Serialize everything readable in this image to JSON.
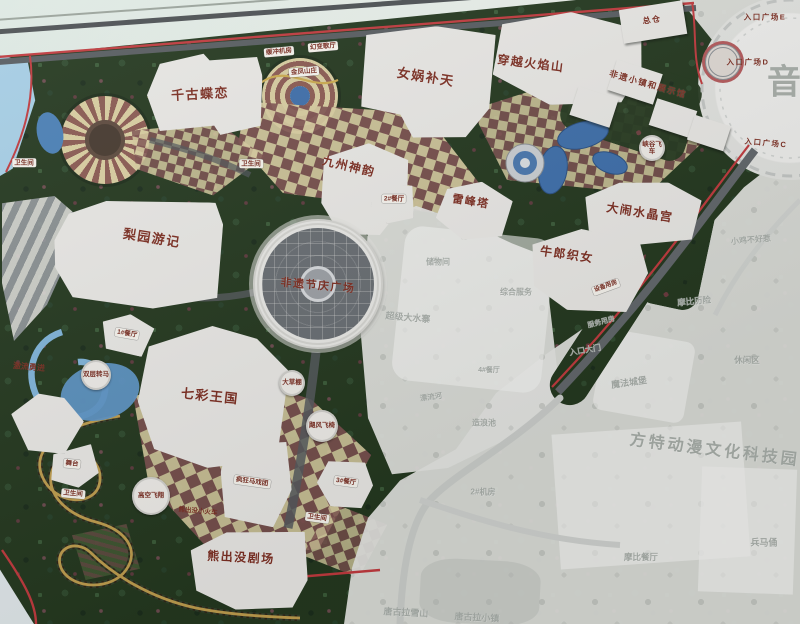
{
  "colors": {
    "label_red": "#7a2f24",
    "boundary_red": "#bf3a3e",
    "ghost_gray": "#a7ada8",
    "building_white": "#e7e6e3",
    "foliage_green": "#24381f",
    "checker_maroon": "#7d5150",
    "checker_cream": "#d6cb9f",
    "water_blue": "#3e6ea9",
    "coaster_gold": "#bd9c4e",
    "plaza_gray": "#686d72"
  },
  "labels": {
    "major": [
      {
        "name": "label-qiangu-dielian",
        "text": "千古蝶恋",
        "x": 200,
        "y": 93,
        "rot": -3,
        "fs": 13
      },
      {
        "name": "label-nuwa-butian",
        "text": "女娲补天",
        "x": 426,
        "y": 76,
        "rot": 9,
        "fs": 13
      },
      {
        "name": "label-chuanyue-huoyanshan",
        "text": "穿越火焰山",
        "x": 531,
        "y": 63,
        "rot": 7,
        "fs": 12
      },
      {
        "name": "label-jiuzhou-shenyun",
        "text": "九州神韵",
        "x": 349,
        "y": 166,
        "rot": 13,
        "fs": 12
      },
      {
        "name": "label-leifengta",
        "text": "雷峰塔",
        "x": 471,
        "y": 201,
        "rot": 9,
        "fs": 11
      },
      {
        "name": "label-danao-shuijinggong",
        "text": "大闹水晶宫",
        "x": 640,
        "y": 212,
        "rot": 9,
        "fs": 12
      },
      {
        "name": "label-niulang-zhinv",
        "text": "牛郎织女",
        "x": 567,
        "y": 254,
        "rot": 8,
        "fs": 12
      },
      {
        "name": "label-liyuan-youji",
        "text": "梨园游记",
        "x": 152,
        "y": 237,
        "rot": 9,
        "fs": 13
      },
      {
        "name": "label-feiyi-jieqing-plaza",
        "text": "非遗节庆广场",
        "x": 318,
        "y": 285,
        "rot": 5,
        "fs": 11
      },
      {
        "name": "label-qicai-wangguo",
        "text": "七彩王国",
        "x": 210,
        "y": 395,
        "rot": 6,
        "fs": 13
      },
      {
        "name": "label-xiongchumo-juchang",
        "text": "熊出没剧场",
        "x": 241,
        "y": 557,
        "rot": 3,
        "fs": 12
      },
      {
        "name": "label-zongcang",
        "text": "总仓",
        "x": 652,
        "y": 20,
        "rot": -8,
        "fs": 8
      },
      {
        "name": "label-feiyi-xiaozhen",
        "text": "非遗小镇和展示馆",
        "x": 648,
        "y": 84,
        "rot": 16,
        "fs": 8.5
      },
      {
        "name": "label-entrance-plaza-e",
        "text": "入口广场E",
        "x": 765,
        "y": 17,
        "rot": 0,
        "fs": 7.5
      },
      {
        "name": "label-entrance-plaza-d",
        "text": "入口广场D",
        "x": 748,
        "y": 62,
        "rot": 0,
        "fs": 7.5
      },
      {
        "name": "label-entrance-plaza-c",
        "text": "入口广场C",
        "x": 766,
        "y": 143,
        "rot": 5,
        "fs": 7.5
      }
    ],
    "pills": [
      {
        "name": "label-toilet-1",
        "text": "卫生间",
        "x": 24,
        "y": 163,
        "rot": 0
      },
      {
        "name": "label-toilet-2",
        "text": "卫生间",
        "x": 251,
        "y": 164,
        "rot": 0
      },
      {
        "name": "label-huanchong-jifang",
        "text": "缓冲机房",
        "x": 279,
        "y": 52,
        "rot": -5
      },
      {
        "name": "label-huanbian-geting",
        "text": "幻变歌厅",
        "x": 323,
        "y": 47,
        "rot": -5
      },
      {
        "name": "label-jinfeng-shanzhuang",
        "text": "金凤山庄",
        "x": 304,
        "y": 72,
        "rot": -5
      },
      {
        "name": "label-restaurant-2",
        "text": "2#餐厅",
        "x": 394,
        "y": 199,
        "rot": 0
      },
      {
        "name": "label-restaurant-1",
        "text": "1#餐厅",
        "x": 127,
        "y": 334,
        "rot": 10
      },
      {
        "name": "label-wutai",
        "text": "舞台",
        "x": 72,
        "y": 464,
        "rot": 5
      },
      {
        "name": "label-toilet-3",
        "text": "卫生间",
        "x": 73,
        "y": 494,
        "rot": 5
      },
      {
        "name": "label-fengkuang-maxituan",
        "text": "疯狂马戏团",
        "x": 252,
        "y": 482,
        "rot": 8
      },
      {
        "name": "label-restaurant-3",
        "text": "3#餐厅",
        "x": 346,
        "y": 482,
        "rot": 8
      },
      {
        "name": "label-toilet-4",
        "text": "卫生间",
        "x": 317,
        "y": 518,
        "rot": 8
      },
      {
        "name": "label-shebei-yongfang",
        "text": "设备用房",
        "x": 606,
        "y": 287,
        "rot": -20,
        "fs": 6
      },
      {
        "name": "label-jiliu-yongjin",
        "text": "激流勇进",
        "x": 29,
        "y": 367,
        "rot": 5,
        "bare": true
      },
      {
        "name": "label-xiongchumo-train",
        "text": "熊出没小火车",
        "x": 198,
        "y": 510,
        "rot": 5,
        "bare": true,
        "fs": 6.5
      }
    ],
    "circles": [
      {
        "name": "label-gaokong-feixiang",
        "text": "高空飞翔",
        "x": 151,
        "y": 496,
        "d": 38
      },
      {
        "name": "label-jufeng-feiyi",
        "text": "飓风飞椅",
        "x": 322,
        "y": 426,
        "d": 32
      },
      {
        "name": "label-shuangceng-zhuanma",
        "text": "双层转马",
        "x": 96,
        "y": 375,
        "d": 30
      },
      {
        "name": "label-dacaopeng",
        "text": "大草棚",
        "x": 292,
        "y": 383,
        "d": 26
      },
      {
        "name": "label-xiagu-feiche",
        "text": "峡谷飞车",
        "x": 652,
        "y": 148,
        "d": 26
      }
    ],
    "ghosts": [
      {
        "name": "ghost-chuwujian",
        "text": "储物间",
        "x": 438,
        "y": 262,
        "rot": 0,
        "fs": 8
      },
      {
        "name": "ghost-zonghe-fuwu",
        "text": "综合服务",
        "x": 516,
        "y": 292,
        "rot": 0,
        "fs": 8
      },
      {
        "name": "ghost-chaoji-dashuizhai",
        "text": "超级大水寨",
        "x": 408,
        "y": 317,
        "rot": 5,
        "fs": 9
      },
      {
        "name": "ghost-restaurant-4",
        "text": "4#餐厅",
        "x": 489,
        "y": 370,
        "rot": 0,
        "fs": 7
      },
      {
        "name": "ghost-piaoliuhe",
        "text": "漂流河",
        "x": 431,
        "y": 397,
        "rot": -8,
        "fs": 7.5
      },
      {
        "name": "ghost-zaolangchi",
        "text": "造浪池",
        "x": 484,
        "y": 423,
        "rot": 0,
        "fs": 8
      },
      {
        "name": "ghost-jifang-2",
        "text": "2#机房",
        "x": 483,
        "y": 492,
        "rot": 0,
        "fs": 8
      },
      {
        "name": "ghost-tanggula-xueshan",
        "text": "唐古拉雪山",
        "x": 406,
        "y": 612,
        "rot": 3,
        "fs": 9
      },
      {
        "name": "ghost-tanggula-xiaozhen",
        "text": "唐古拉小镇",
        "x": 477,
        "y": 617,
        "rot": 3,
        "fs": 9
      },
      {
        "name": "ghost-xiaoji-buhaore",
        "text": "小鸡不好惹",
        "x": 751,
        "y": 240,
        "rot": -5,
        "fs": 8
      },
      {
        "name": "ghost-mobi-lixian",
        "text": "摩比历险",
        "x": 694,
        "y": 301,
        "rot": -5,
        "fs": 8.5
      },
      {
        "name": "ghost-xiuxianqu",
        "text": "休闲区",
        "x": 747,
        "y": 360,
        "rot": 0,
        "fs": 8.5
      },
      {
        "name": "ghost-mofa-chengbao",
        "text": "魔法城堡",
        "x": 629,
        "y": 382,
        "rot": -8,
        "fs": 9
      },
      {
        "name": "ghost-rukou-damen",
        "text": "入口大门",
        "x": 585,
        "y": 350,
        "rot": -10,
        "fs": 8
      },
      {
        "name": "ghost-fuwu-yongfang",
        "text": "服务用房",
        "x": 601,
        "y": 322,
        "rot": -15,
        "fs": 7
      },
      {
        "name": "ghost-bingmayong",
        "text": "兵马俑",
        "x": 764,
        "y": 542,
        "rot": 0,
        "fs": 9
      },
      {
        "name": "ghost-mobi-canting",
        "text": "摩比餐厅",
        "x": 641,
        "y": 557,
        "rot": 0,
        "fs": 8.5
      },
      {
        "name": "ghost-park-title",
        "text": "方特动漫文化科技园",
        "x": 715,
        "y": 448,
        "rot": 7,
        "fs": 16,
        "ls": 3
      },
      {
        "name": "ghost-char-yin",
        "text": "音",
        "x": 784,
        "y": 79,
        "rot": 0,
        "fs": 34
      }
    ]
  }
}
